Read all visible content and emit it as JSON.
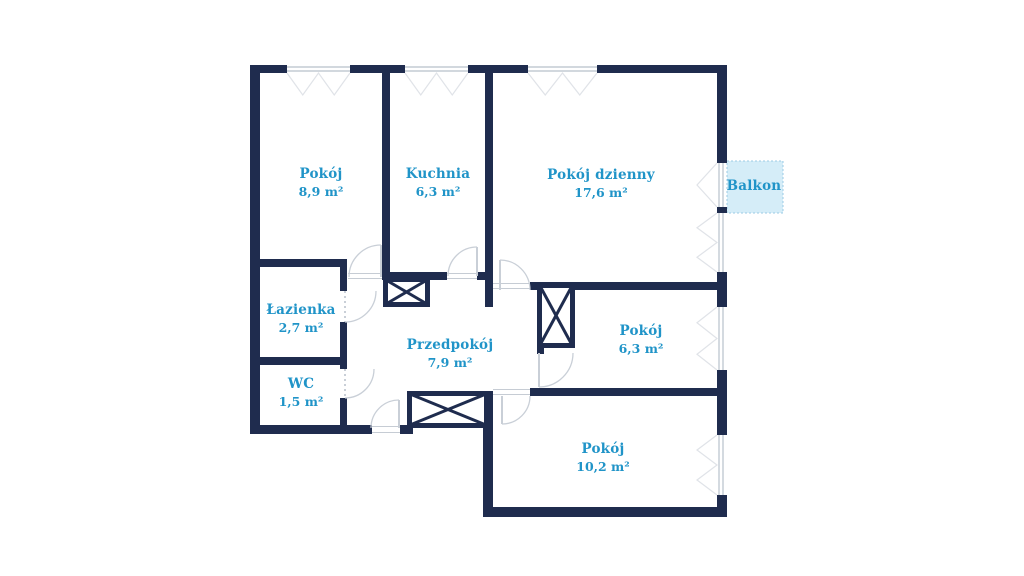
{
  "plan_title": "apartment floor plan",
  "rooms": [
    {
      "name": "Pokój",
      "area": "8,9 m²"
    },
    {
      "name": "Kuchnia",
      "area": "6,3 m²"
    },
    {
      "name": "Pokój dzienny",
      "area": "17,6 m²"
    },
    {
      "name": "Łazienka",
      "area": "2,7 m²"
    },
    {
      "name": "WC",
      "area": "1,5 m²"
    },
    {
      "name": "Przedpokój",
      "area": "7,9 m²"
    },
    {
      "name": "Pokój",
      "area": "6,3 m²"
    },
    {
      "name": "Pokój",
      "area": "10,2 m²"
    },
    {
      "name": "Balkon",
      "area": ""
    }
  ],
  "colors": {
    "wall": "#1f2c4e",
    "label": "#2094c8",
    "door": "#c9cfd7",
    "threshold": "#c6ccd4",
    "window_frame": "#b8c0cb",
    "window_mark": "#e0e3e8",
    "balcony_fill": "#d5edf8",
    "balcony_border": "#9ccbe5"
  }
}
